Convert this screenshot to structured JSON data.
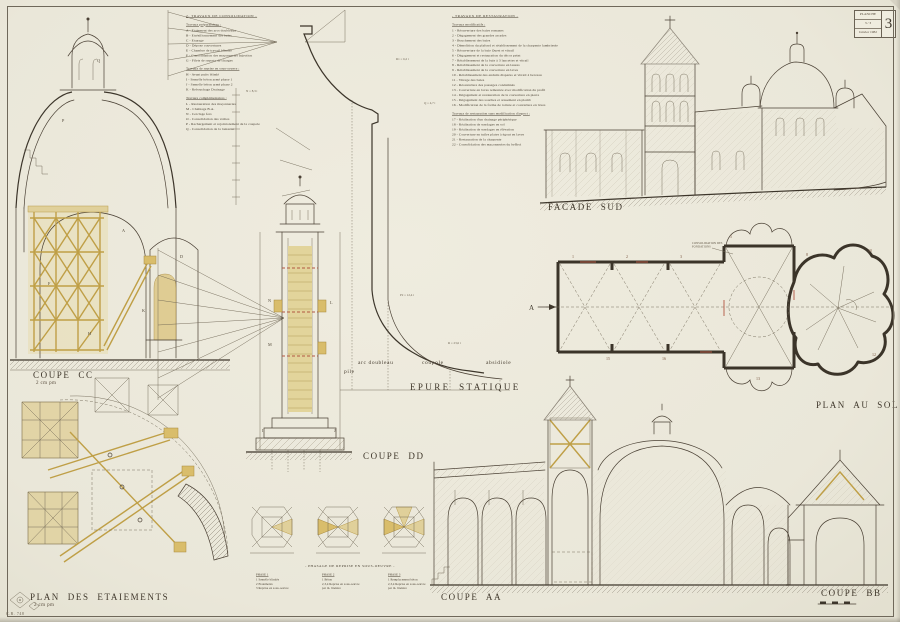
{
  "stamp": {
    "title": "PLANCHE",
    "mid": "3 / 3",
    "date": "Janvier 1982",
    "number": "3"
  },
  "corner_mark": "C.R. 748",
  "labels": {
    "coupe_cc": "COUPE CC",
    "coupe_cc_scale": "2 cm pm",
    "coupe_dd": "COUPE DD",
    "epure": "EPURE STATIQUE",
    "pile": "pile",
    "arc_doubleau": "arc doubleau",
    "coupole": "coupole",
    "absidiole": "absidiole",
    "facade_sud": "FACADE SUD",
    "plan_au_sol": "PLAN AU SOL",
    "plan_etaiements": "PLAN DES ETAIEMENTS",
    "plan_etaiements_scale": "2 cm pm",
    "coupe_aa": "COUPE AA",
    "coupe_bb": "COUPE BB",
    "phasage_title": "- PHASAGE DE REPRISE EN SOUS-OEUVRE -",
    "note_fondations": "Consolidation des fondations"
  },
  "consolidation_lines": [
    {
      "c": "t",
      "t": "2- TRAVAUX DE CONSOLIDATION -"
    },
    {
      "c": "h",
      "t": "Travaux préparatoires :"
    },
    {
      "c": "i",
      "t": "A  -  Etaiement des arcs doubleaux"
    },
    {
      "c": "i",
      "t": "B  -  Etrésillonnement des baies"
    },
    {
      "c": "i",
      "t": "C  -  Etayage"
    },
    {
      "c": "i",
      "t": "D  -  Dépose couvertures"
    },
    {
      "c": "i",
      "t": "E  -  Chambre de travail blindée"
    },
    {
      "c": "i",
      "t": "F  -  Consolidation des maçonneries  Injection"
    },
    {
      "c": "i",
      "t": "G  -  Filets de reports de charges"
    },
    {
      "c": "h",
      "t": "Travaux de reprise en sous-oeuvre :"
    },
    {
      "c": "i",
      "t": "H  -  Avant puits blindé"
    },
    {
      "c": "i",
      "t": "I   -  Semelle béton armé phase 1"
    },
    {
      "c": "i",
      "t": "J   -  Semelle béton armé phase 2"
    },
    {
      "c": "i",
      "t": "K  -  Rebouchage  Drainage"
    },
    {
      "c": "h",
      "t": "Travaux complémentaires :"
    },
    {
      "c": "i",
      "t": "L  -  Restauration des maçonneries"
    },
    {
      "c": "i",
      "t": "M -  Chaînage B.A."
    },
    {
      "c": "i",
      "t": "N  -  Cerclage fers"
    },
    {
      "c": "i",
      "t": "O  -  Consolidation des voûtes"
    },
    {
      "c": "i",
      "t": "P  -  Rechargement et rejointoiement de la coupole"
    },
    {
      "c": "i",
      "t": "Q  -  Consolidation de la lanterne"
    }
  ],
  "restauration_lines": [
    {
      "c": "t",
      "t": "- TRAVAUX DE RESTAURATION -"
    },
    {
      "c": "h",
      "t": "Travaux modificatifs :"
    },
    {
      "c": "i",
      "t": "1   -  Réouverture des baies romanes"
    },
    {
      "c": "i",
      "t": "2   -  Dégagement des grandes arcades"
    },
    {
      "c": "i",
      "t": "3   -  Bouchement des baies"
    },
    {
      "c": "i",
      "t": "4   -  Démolition du plafond et rétablissement de la charpente lambrissée"
    },
    {
      "c": "i",
      "t": "5   -  Réouverture de la baie Ouest et vitrail"
    },
    {
      "c": "i",
      "t": "6   -  Dégagement et restauration du décor peint"
    },
    {
      "c": "i",
      "t": "7   -  Rétablissement de la baie à 3 lancettes et vitrail"
    },
    {
      "c": "i",
      "t": "8   -  Rétablissement de la couverture en lauzes"
    },
    {
      "c": "i",
      "t": "9   -  Rétablissement de la couverture en laves"
    },
    {
      "c": "i",
      "t": "10 -  Rétablissement des enduits disparus et vitrail à berceau"
    },
    {
      "c": "i",
      "t": "11 -  Vitrage des baies"
    },
    {
      "c": "i",
      "t": "12 -  Réouverture des passages condamnés"
    },
    {
      "c": "i",
      "t": "13 -  Couverture en laves remontée avec modification du profil"
    },
    {
      "c": "i",
      "t": "14 -  Dégagement et restauration de la couverture en pierre"
    },
    {
      "c": "i",
      "t": "15 -  Dégagement des souches et arasement en plomb"
    },
    {
      "c": "i",
      "t": "16 -  Modification de la forme de toiture et couverture en laves"
    },
    {
      "c": "h",
      "t": "Travaux de restauration sans modification d'aspect :"
    },
    {
      "c": "i",
      "t": "17 -  Réalisation d'un drainage périphérique"
    },
    {
      "c": "i",
      "t": "18 -  Réalisation de sondages en sol"
    },
    {
      "c": "i",
      "t": "19 -  Réalisation de sondages en élévation"
    },
    {
      "c": "i",
      "t": "20 -  Couverture en tuiles plates à égout en laves"
    },
    {
      "c": "i",
      "t": "21 -  Restauration de la charpente"
    },
    {
      "c": "i",
      "t": "22 -  Consolidation des maçonneries du beffroi"
    }
  ],
  "phases": [
    {
      "name": "PHASE 1",
      "lines": [
        "1  Semelle blindée",
        "2  Etaiements",
        "3  Reprise en sous-oeuvre"
      ]
    },
    {
      "name": "PHASE 2",
      "lines": [
        "1  Béton",
        "2,3,4  Reprise en sous-oeuvre",
        "par m. linéaire"
      ]
    },
    {
      "name": "PHASE 3",
      "lines": [
        "1  Remplacement béton",
        "2,3,4  Reprise en sous-oeuvre",
        "par m. linéaire"
      ]
    }
  ],
  "svg_texts": [
    {
      "x": 122,
      "y": 232,
      "t": "A",
      "c": "ltr"
    },
    {
      "x": 180,
      "y": 258,
      "t": "D",
      "c": "ltr"
    },
    {
      "x": 48,
      "y": 285,
      "t": "F",
      "c": "ltr"
    },
    {
      "x": 88,
      "y": 335,
      "t": "H",
      "c": "ltr"
    },
    {
      "x": 142,
      "y": 312,
      "t": "K",
      "c": "ltr"
    },
    {
      "x": 97,
      "y": 62,
      "t": "Q",
      "c": "ltr"
    },
    {
      "x": 62,
      "y": 122,
      "t": "P",
      "c": "ltr"
    },
    {
      "x": 396,
      "y": 60,
      "t": "R1 = 6,2 t",
      "c": "sm"
    },
    {
      "x": 424,
      "y": 104,
      "t": "Q = 4,7 t",
      "c": "sm"
    },
    {
      "x": 246,
      "y": 92,
      "t": "N = 8,3 t",
      "c": "sm"
    },
    {
      "x": 400,
      "y": 296,
      "t": "P2 = 12,4 t",
      "c": "sm"
    },
    {
      "x": 448,
      "y": 344,
      "t": "R = 23,6 t",
      "c": "sm"
    },
    {
      "x": 268,
      "y": 302,
      "t": "N",
      "c": "ltr"
    },
    {
      "x": 268,
      "y": 346,
      "t": "M",
      "c": "ltr"
    },
    {
      "x": 330,
      "y": 304,
      "t": "L",
      "c": "ltr"
    },
    {
      "x": 262,
      "y": 432,
      "t": "I",
      "c": "ltr"
    },
    {
      "x": 334,
      "y": 432,
      "t": "J",
      "c": "ltr"
    },
    {
      "x": 572,
      "y": 258,
      "t": "1",
      "c": "num"
    },
    {
      "x": 626,
      "y": 258,
      "t": "2",
      "c": "num"
    },
    {
      "x": 680,
      "y": 258,
      "t": "3",
      "c": "num"
    },
    {
      "x": 730,
      "y": 238,
      "t": "5",
      "c": "num"
    },
    {
      "x": 806,
      "y": 256,
      "t": "8",
      "c": "num"
    },
    {
      "x": 868,
      "y": 252,
      "t": "10",
      "c": "num"
    },
    {
      "x": 872,
      "y": 356,
      "t": "12",
      "c": "num"
    },
    {
      "x": 756,
      "y": 380,
      "t": "13",
      "c": "num"
    },
    {
      "x": 606,
      "y": 360,
      "t": "15",
      "c": "num"
    },
    {
      "x": 662,
      "y": 360,
      "t": "16",
      "c": "num"
    },
    {
      "x": 529,
      "y": 310,
      "t": "A",
      "c": "mark"
    }
  ],
  "colors": {
    "paper": "#ece9dc",
    "ink": "#4a4034",
    "tan": "#d9bd6b",
    "red": "#b25742"
  }
}
